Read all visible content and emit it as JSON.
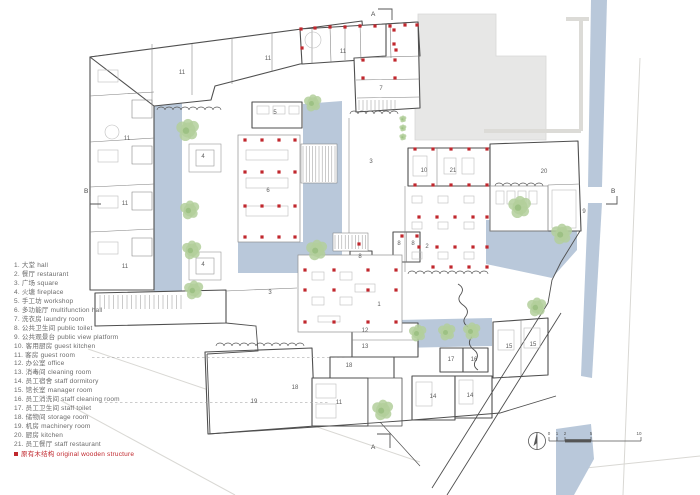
{
  "legend": {
    "items": [
      {
        "num": "1.",
        "zh": "大堂",
        "en": "hall"
      },
      {
        "num": "2.",
        "zh": "餐厅",
        "en": "restaurant"
      },
      {
        "num": "3.",
        "zh": "广场",
        "en": "square"
      },
      {
        "num": "4.",
        "zh": "火塘",
        "en": "fireplace"
      },
      {
        "num": "5.",
        "zh": "手工坊",
        "en": "workshop"
      },
      {
        "num": "6.",
        "zh": "多功能厅",
        "en": "multifunction hall"
      },
      {
        "num": "7.",
        "zh": "洗衣房",
        "en": "laundry room"
      },
      {
        "num": "8.",
        "zh": "公共卫生间",
        "en": "public toilet"
      },
      {
        "num": "9.",
        "zh": "公共观景台",
        "en": "public view platform"
      },
      {
        "num": "10.",
        "zh": "客用厨房",
        "en": "guest kitchen"
      },
      {
        "num": "11.",
        "zh": "客房",
        "en": "guest room"
      },
      {
        "num": "12.",
        "zh": "办公室",
        "en": "office"
      },
      {
        "num": "13.",
        "zh": "消毒间",
        "en": "cleaning room"
      },
      {
        "num": "14.",
        "zh": "员工宿舍",
        "en": "staff dormitory"
      },
      {
        "num": "15.",
        "zh": "馆长室",
        "en": "manager room"
      },
      {
        "num": "16.",
        "zh": "员工消洗间",
        "en": "staff cleaning room"
      },
      {
        "num": "17.",
        "zh": "员工卫生间",
        "en": "staff toilet"
      },
      {
        "num": "18.",
        "zh": "储物间",
        "en": "storage room"
      },
      {
        "num": "19.",
        "zh": "机房",
        "en": "machinery room"
      },
      {
        "num": "20.",
        "zh": "厨房",
        "en": "kitchen"
      },
      {
        "num": "21.",
        "zh": "员工餐厅",
        "en": "staff restaurant"
      }
    ],
    "note": {
      "zh": "原有木结构",
      "en": "original wooden structure"
    }
  },
  "plan": {
    "room_labels": [
      {
        "t": "11",
        "x": 182,
        "y": 74
      },
      {
        "t": "11",
        "x": 268,
        "y": 60
      },
      {
        "t": "11",
        "x": 343,
        "y": 53
      },
      {
        "t": "11",
        "x": 127,
        "y": 140
      },
      {
        "t": "11",
        "x": 125,
        "y": 205
      },
      {
        "t": "11",
        "x": 125,
        "y": 268
      },
      {
        "t": "11",
        "x": 339,
        "y": 404
      },
      {
        "t": "7",
        "x": 381,
        "y": 90
      },
      {
        "t": "5",
        "x": 275,
        "y": 114
      },
      {
        "t": "4",
        "x": 203,
        "y": 158
      },
      {
        "t": "4",
        "x": 203,
        "y": 266
      },
      {
        "t": "3",
        "x": 371,
        "y": 163
      },
      {
        "t": "3",
        "x": 270,
        "y": 294
      },
      {
        "t": "6",
        "x": 268,
        "y": 192
      },
      {
        "t": "10",
        "x": 424,
        "y": 172
      },
      {
        "t": "21",
        "x": 453,
        "y": 172
      },
      {
        "t": "20",
        "x": 544,
        "y": 173
      },
      {
        "t": "2",
        "x": 427,
        "y": 248
      },
      {
        "t": "8",
        "x": 399,
        "y": 245
      },
      {
        "t": "8",
        "x": 413,
        "y": 245
      },
      {
        "t": "8",
        "x": 360,
        "y": 258
      },
      {
        "t": "9",
        "x": 584,
        "y": 213
      },
      {
        "t": "1",
        "x": 379,
        "y": 306
      },
      {
        "t": "12",
        "x": 365,
        "y": 332
      },
      {
        "t": "13",
        "x": 365,
        "y": 348
      },
      {
        "t": "18",
        "x": 349,
        "y": 367
      },
      {
        "t": "18",
        "x": 295,
        "y": 389
      },
      {
        "t": "19",
        "x": 254,
        "y": 403
      },
      {
        "t": "17",
        "x": 451,
        "y": 361
      },
      {
        "t": "16",
        "x": 474,
        "y": 361
      },
      {
        "t": "14",
        "x": 433,
        "y": 398
      },
      {
        "t": "14",
        "x": 470,
        "y": 397
      },
      {
        "t": "15",
        "x": 509,
        "y": 348
      },
      {
        "t": "15",
        "x": 533,
        "y": 346
      }
    ],
    "red_dots": [
      [
        301,
        29
      ],
      [
        315,
        28
      ],
      [
        330,
        27
      ],
      [
        345,
        27
      ],
      [
        360,
        26
      ],
      [
        375,
        26
      ],
      [
        390,
        26
      ],
      [
        405,
        25
      ],
      [
        417,
        25
      ],
      [
        302,
        48
      ],
      [
        396,
        50
      ],
      [
        394,
        30
      ],
      [
        394,
        44
      ],
      [
        363,
        60
      ],
      [
        395,
        60
      ],
      [
        363,
        78
      ],
      [
        395,
        78
      ],
      [
        415,
        149
      ],
      [
        433,
        149
      ],
      [
        451,
        149
      ],
      [
        469,
        149
      ],
      [
        487,
        149
      ],
      [
        415,
        185
      ],
      [
        433,
        185
      ],
      [
        451,
        185
      ],
      [
        469,
        185
      ],
      [
        487,
        185
      ],
      [
        419,
        217
      ],
      [
        437,
        217
      ],
      [
        455,
        217
      ],
      [
        473,
        217
      ],
      [
        487,
        217
      ],
      [
        419,
        247
      ],
      [
        437,
        247
      ],
      [
        455,
        247
      ],
      [
        473,
        247
      ],
      [
        487,
        247
      ],
      [
        433,
        267
      ],
      [
        451,
        267
      ],
      [
        469,
        267
      ],
      [
        487,
        267
      ],
      [
        245,
        140
      ],
      [
        262,
        140
      ],
      [
        279,
        140
      ],
      [
        295,
        140
      ],
      [
        245,
        172
      ],
      [
        262,
        172
      ],
      [
        279,
        172
      ],
      [
        295,
        172
      ],
      [
        245,
        206
      ],
      [
        262,
        206
      ],
      [
        279,
        206
      ],
      [
        295,
        206
      ],
      [
        245,
        237
      ],
      [
        262,
        237
      ],
      [
        279,
        237
      ],
      [
        295,
        237
      ],
      [
        305,
        270
      ],
      [
        334,
        270
      ],
      [
        368,
        270
      ],
      [
        396,
        270
      ],
      [
        305,
        290
      ],
      [
        334,
        290
      ],
      [
        368,
        290
      ],
      [
        396,
        290
      ],
      [
        305,
        322
      ],
      [
        334,
        322
      ],
      [
        368,
        322
      ],
      [
        396,
        322
      ],
      [
        402,
        236
      ],
      [
        417,
        236
      ],
      [
        359,
        244
      ]
    ],
    "trees": [
      [
        188,
        130,
        13
      ],
      [
        190,
        210,
        11
      ],
      [
        192,
        250,
        11
      ],
      [
        194,
        290,
        11
      ],
      [
        313,
        103,
        10
      ],
      [
        317,
        250,
        12
      ],
      [
        520,
        207,
        13
      ],
      [
        562,
        234,
        12
      ],
      [
        418,
        333,
        10
      ],
      [
        447,
        332,
        10
      ],
      [
        472,
        331,
        10
      ],
      [
        537,
        307,
        11
      ],
      [
        383,
        410,
        12
      ],
      [
        403,
        119,
        4
      ],
      [
        403,
        128,
        4
      ],
      [
        403,
        137,
        4
      ]
    ],
    "section_markers": [
      {
        "t": "A",
        "x": 371,
        "y": 16,
        "tick": "378,9 392,9 392,20"
      },
      {
        "t": "A",
        "x": 371,
        "y": 449,
        "tick": "377,434 390,434 390,448"
      },
      {
        "t": "B",
        "x": 84,
        "y": 193,
        "tick": "90,196 90,204 101,204"
      },
      {
        "t": "B",
        "x": 611,
        "y": 193,
        "tick": "617,196 617,204 606,204"
      }
    ],
    "scalebar": {
      "labels": [
        {
          "t": "0",
          "x": 549
        },
        {
          "t": "1",
          "x": 557
        },
        {
          "t": "2",
          "x": 565
        },
        {
          "t": "5",
          "x": 591
        },
        {
          "t": "10",
          "x": 639
        }
      ]
    }
  },
  "colors": {
    "red": "#c0272d",
    "water": "#b9c8da",
    "tree": "#b3cf9b",
    "tree_dark": "#97bd7e",
    "gray_mass": "#e7e7e6",
    "wall": "#4f4f4f",
    "site": "#d9d8d4",
    "text": "#5c5c5c"
  }
}
